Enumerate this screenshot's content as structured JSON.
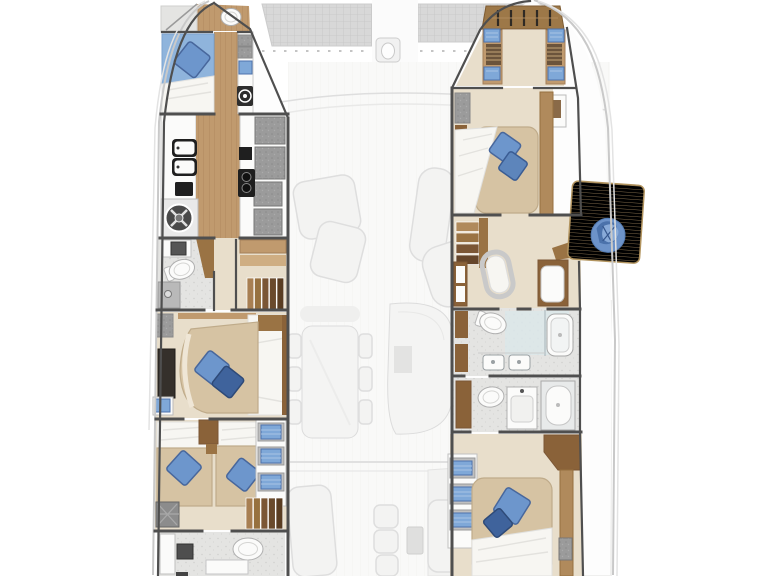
{
  "plan": {
    "type": "catamaran-lower-deck-floor-plan",
    "port_hull": {
      "rooms": [
        {
          "name": "forward-head",
          "items": [
            "toilet",
            "shower",
            "wood-floor"
          ]
        },
        {
          "name": "forward-cabin",
          "items": [
            "single-berth-blue",
            "pillow",
            "storage-cabinets",
            "washer-hatch",
            "wood-corridor"
          ]
        },
        {
          "name": "galley",
          "items": [
            "double-sink",
            "small-appliance",
            "washing-machine",
            "cooktop",
            "fridge-cabinets",
            "counters",
            "wood-corridor"
          ]
        },
        {
          "name": "mid-head",
          "items": [
            "toilet",
            "sink",
            "shower"
          ]
        },
        {
          "name": "mid-cabin",
          "items": [
            "double-berth",
            "two-pillows",
            "dark-wardrobe",
            "storage-cabinet",
            "blue-locker",
            "staircase"
          ]
        },
        {
          "name": "aft-cabin",
          "items": [
            "twin-berths",
            "two-pillows",
            "towel-shelves",
            "staircase",
            "engine-hatch"
          ]
        },
        {
          "name": "aft-head",
          "items": [
            "toilet",
            "sink",
            "counter",
            "cabinet"
          ]
        }
      ]
    },
    "starboard_hull": {
      "rooms": [
        {
          "name": "bow-wardrobe",
          "items": [
            "hanging-locker",
            "blue-cushions",
            "striped-drawers",
            "side-lockers"
          ]
        },
        {
          "name": "forward-cabin",
          "items": [
            "double-berth",
            "two-pillows",
            "white-bedding",
            "wood-wall",
            "storage-cabinet"
          ]
        },
        {
          "name": "landing",
          "items": [
            "staircase",
            "vanity-seat",
            "desk-lockers",
            "aft-cabinet"
          ]
        },
        {
          "name": "forward-bathroom",
          "items": [
            "toilet",
            "twin-sinks",
            "shower-unit",
            "glass-partition"
          ]
        },
        {
          "name": "aft-bathroom",
          "items": [
            "toilet",
            "sink-counter",
            "shower-tray"
          ]
        },
        {
          "name": "aft-cabin",
          "items": [
            "double-berth",
            "two-pillows",
            "white-bedding",
            "towel-shelves",
            "wood-rail"
          ]
        }
      ],
      "balcony": {
        "items": [
          "teak-fold-out-platform",
          "blue-beanbag"
        ]
      }
    },
    "ghost_deck": {
      "items": [
        "bow-trampolines",
        "bow-walkway",
        "anchor-fitting",
        "foredeck-seat-line",
        "coachroof-curve",
        "salon-sofa-left",
        "salon-chaise-right",
        "dining-table",
        "dining-chairs",
        "helm-lounge",
        "cockpit-bench-left",
        "cockpit-seats",
        "cockpit-table",
        "cockpit-bench-right",
        "transom-line"
      ]
    }
  },
  "palette": {
    "wall": "#4f4f4f",
    "hull_line": "#c9c9c9",
    "ghost_line": "#dedede",
    "ghost_fill": "#f3f3f2",
    "tramp_fill": "#d8d8d8",
    "tramp_line": "#c6c6c6",
    "wood": "#c09a6e",
    "wood_line": "#ab8459",
    "wood_dark": "#9a7344",
    "trim_brown": "#8a6239",
    "step_dark": "#5f3f24",
    "floor_beige": "#e8decb",
    "bed_base": "#d6c3a3",
    "bed_white": "#f7f6f2",
    "blue_bed": "#8fb4dc",
    "pillow_blue": "#6d96cc",
    "pillow_mid": "#5d85bb",
    "pillow_dark": "#3f639c",
    "towel_blue": "#7fa8d8",
    "teak": "#c9ab80",
    "teak_line": "#b5966a",
    "tile": "#e4e4e2",
    "tile_dot": "#cdcdcb",
    "fixture": "#fbfbfa",
    "fixture_line": "#b0b0b0",
    "gray_cab": "#a3a3a3",
    "gray_dark": "#6f6f6f",
    "appliance": "#1f1f1f",
    "glass": "#dbe7ea"
  }
}
